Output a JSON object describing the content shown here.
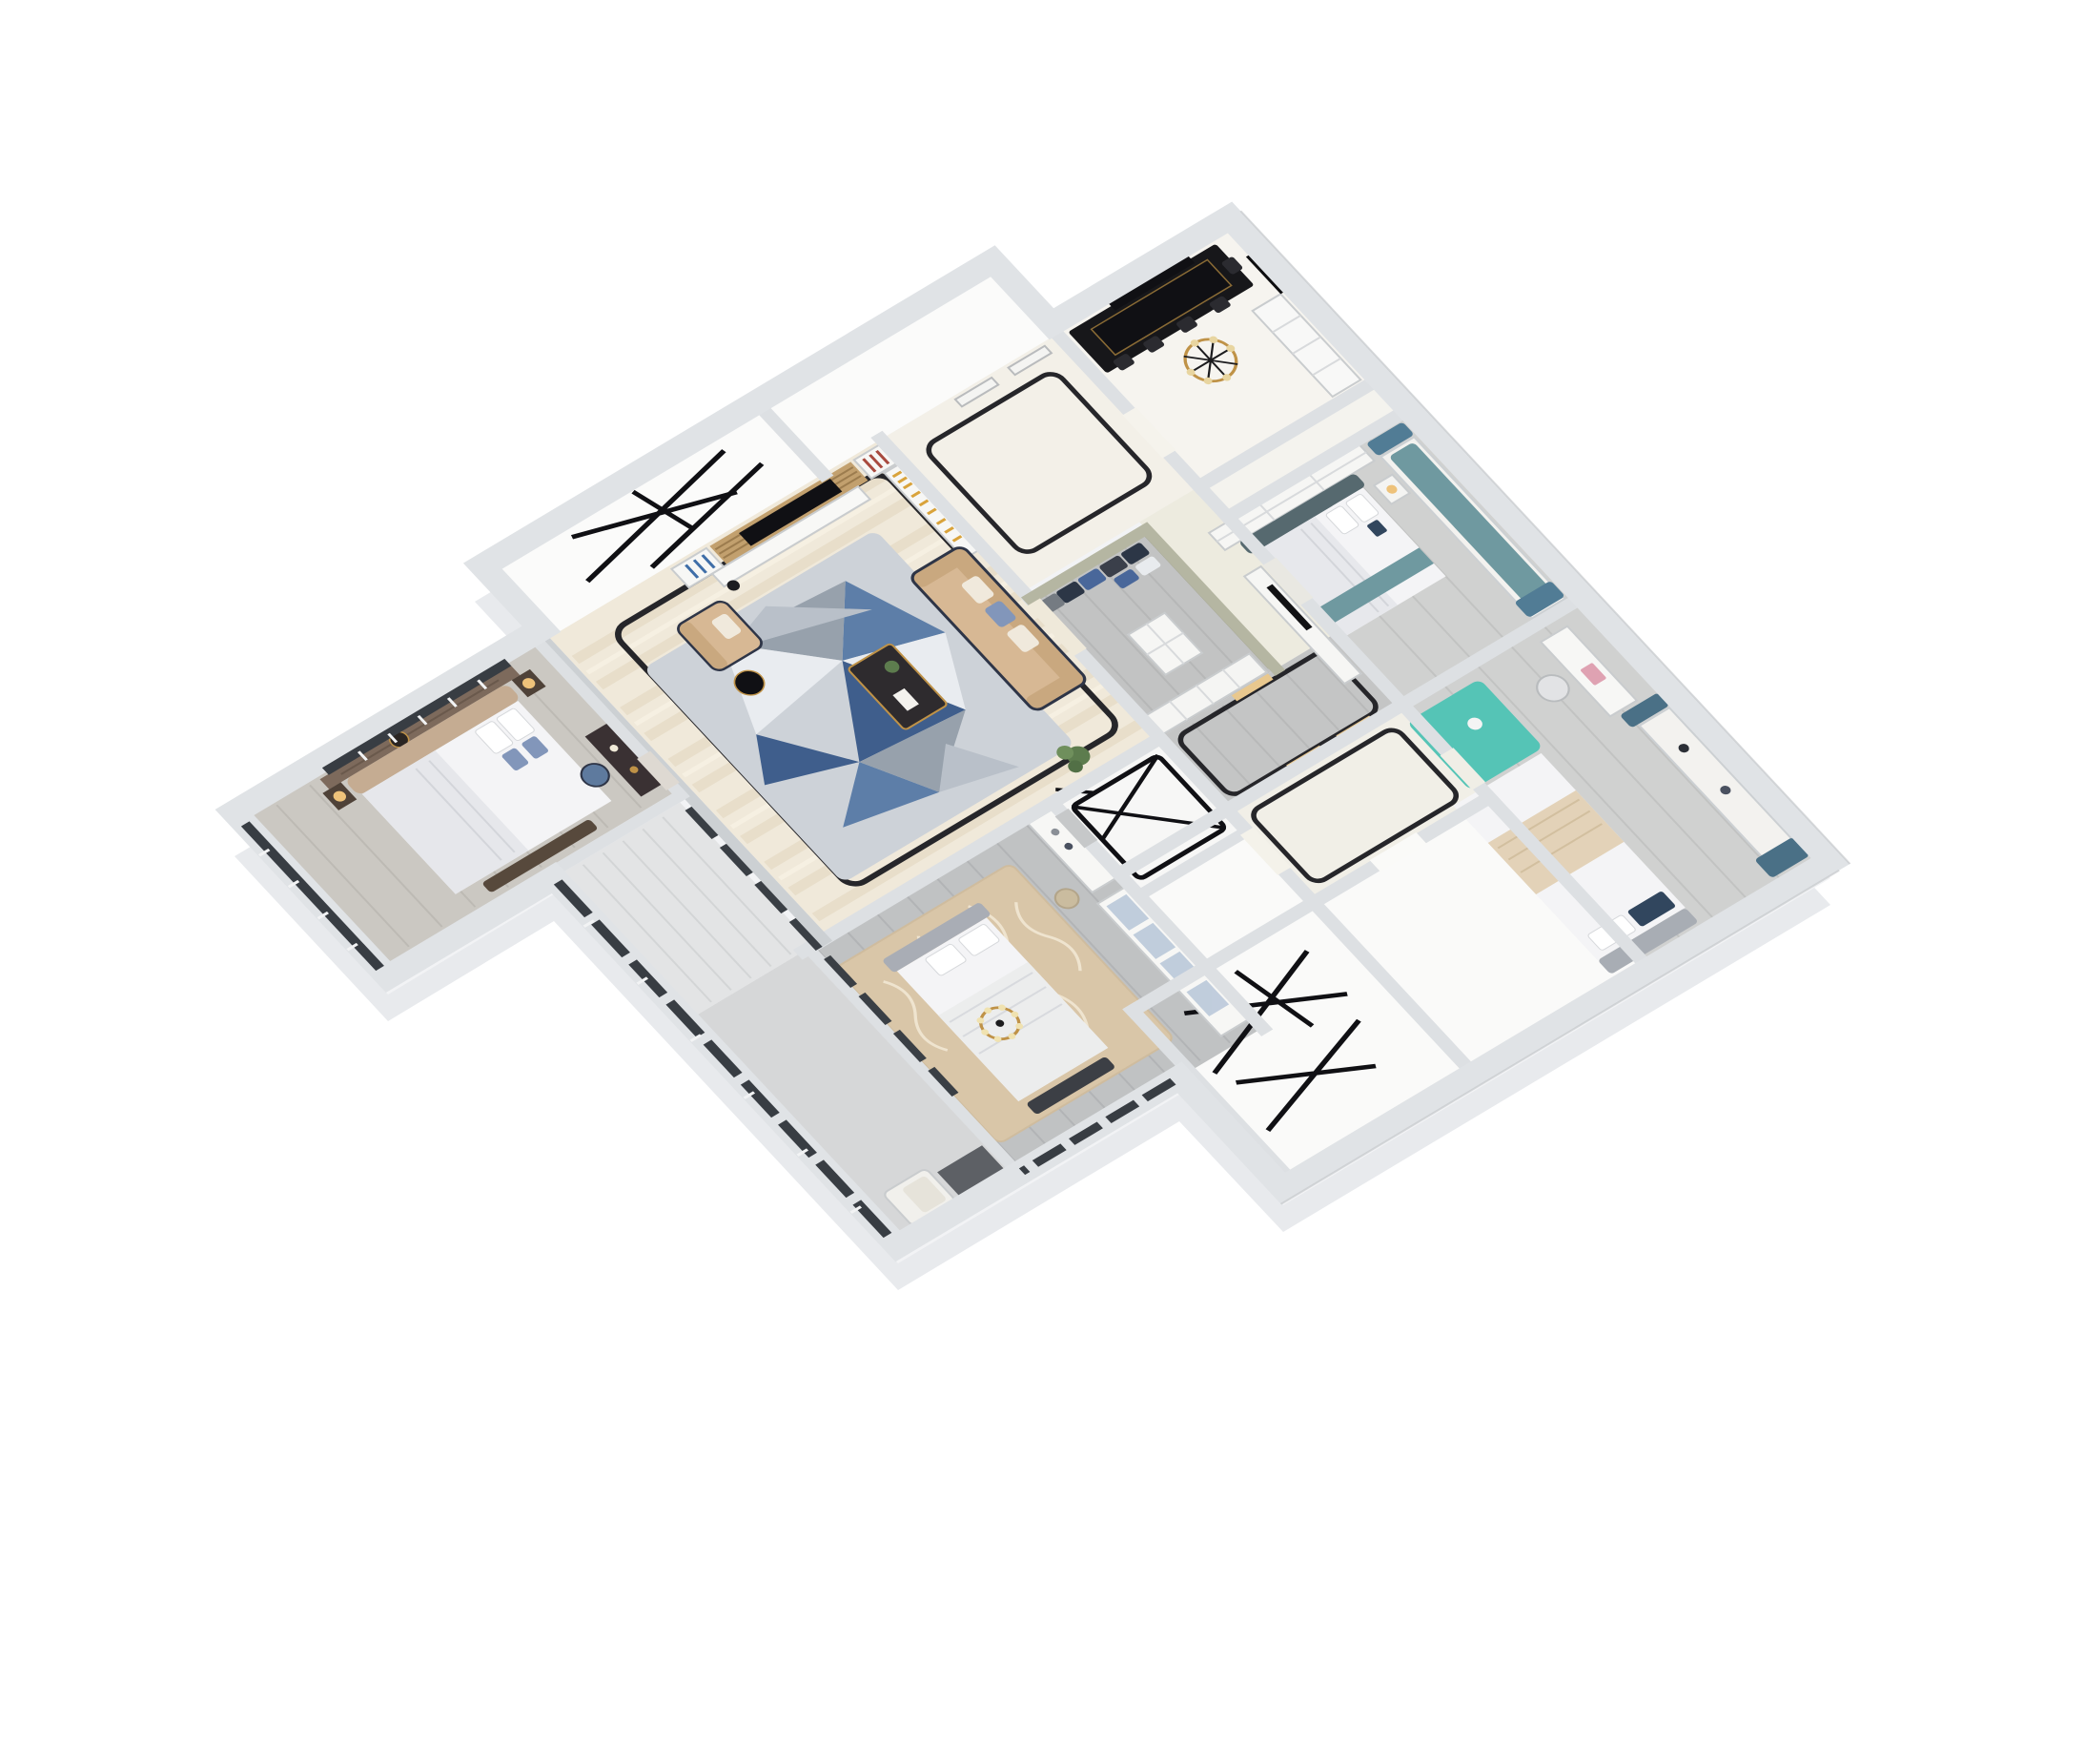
{
  "scene": {
    "description": "3D isometric dollhouse floor-plan rendering of a four-bedroom apartment, viewed from above at an angle on a plain white background",
    "view": "axonometric top-down",
    "background": "#ffffff"
  },
  "palette": {
    "background": "#ffffff",
    "wall_top": "#dde0e3",
    "wall_exterior": "#e0e3e6",
    "wall_khaki": "#b5b6a2",
    "extrude_side": "#e8eaed",
    "extrude_side_light": "#f2f3f5",
    "floor_white": "#fafaf8",
    "floor_marble": "#f3f0e8",
    "floor_wood_gray": "#cfd0cf",
    "floor_wood_dark": "#c0c2c3",
    "floor_master": "#cbc8c2",
    "floor_balcony": "#e3e4e5",
    "floor_corridor_south": "#d6d7d8",
    "living_marble": "#f0e9da",
    "marble_streak": "#e0d4ba",
    "inlay_black": "#26262a",
    "rug_base": "#cdd2d8",
    "rug_blue": "#5d7ea8",
    "rug_blue_dark": "#3f5e8c",
    "rug_gray": "#97a1ac",
    "rug_white": "#e9ecf0",
    "sofa_beige": "#d7b894",
    "sofa_shadow": "#c9a87f",
    "sofa_trim": "#2e3547",
    "table_dark": "#2e2b2e",
    "gold": "#bf9247",
    "gold_light": "#e8d5a0",
    "ink": "#101014",
    "bed_slate": "#56696f",
    "teal_cushion": "#6f99a0",
    "curtain_blue": "#517c95",
    "curtain_steel": "#4a7086",
    "rug_teal": "#55c4b6",
    "laptop_pink": "#dfa2b2",
    "pillow_navy": "#31465e",
    "master_brown": "#7d6a5c",
    "headboard_tan": "#c5ac92",
    "pillow_blue": "#8296ba",
    "bedding_white": "#f4f4f6",
    "duvet_gray": "#e6e7eb",
    "rug_beige": "#d9c6a8",
    "rug_beige_line": "#efe4cf",
    "wardrobe_glass": "#b7c6d8",
    "frame_dark": "#383d43",
    "bench_dark": "#3c3f45",
    "plant_green": "#5d7c4e",
    "lamp_warm": "#eec27a",
    "niche_warm": "#e9c88e",
    "clothes_navy": "#2c3646",
    "clothes_blue": "#49679a",
    "clothes_gray": "#757b82",
    "clothes_white": "#e8ebee",
    "chair_blue": "#5e7a9e",
    "cabinet_white": "#f7f7f5",
    "cabinet_stroke": "#c9ccce"
  },
  "rooms": [
    {
      "id": "dining-room",
      "features": [
        "gold-black chandelier",
        "black dining table",
        "black chairs",
        "white sideboard",
        "black framed screen",
        "dark doorway"
      ]
    },
    {
      "id": "bedroom-blue",
      "features": [
        "slate-teal bed",
        "teal window bench",
        "blue curtains",
        "wardrobe",
        "tv cabinet",
        "nightstand lamp"
      ]
    },
    {
      "id": "bedroom-study",
      "features": [
        "white desk",
        "pink laptop",
        "desk chair",
        "bright teal rug",
        "white bed",
        "steel-blue curtains",
        "window bench"
      ]
    },
    {
      "id": "foyer",
      "features": [
        "marble floor",
        "black rounded floor inlay",
        "doors"
      ]
    },
    {
      "id": "hallway",
      "features": [
        "marble floor",
        "black rounded floor inlay",
        "lit shelf niches"
      ]
    },
    {
      "id": "walk-in-closet",
      "features": [
        "hanging clothes",
        "glass front",
        "drawers",
        "shelves"
      ]
    },
    {
      "id": "shower-room",
      "features": [
        "black framed glass shower enclosure"
      ]
    },
    {
      "id": "utility-room-nw",
      "features": [
        "empty room",
        "black easel frames"
      ]
    },
    {
      "id": "utility-room-se",
      "features": [
        "empty room",
        "black easel frames"
      ]
    },
    {
      "id": "living-room",
      "features": [
        "wood slat tv wall",
        "black tv",
        "bookshelves",
        "geometric blue-gray rug",
        "beige sofa",
        "beige armchair",
        "dark coffee table",
        "black round side table",
        "plant",
        "streaked marble floor",
        "black floor inlay"
      ]
    },
    {
      "id": "master-bedroom",
      "features": [
        "brown padded headboard wall",
        "tan curved headboard",
        "blue-white pillows",
        "vanity desk",
        "blue chair",
        "warm lamps",
        "dark bay window"
      ]
    },
    {
      "id": "bedroom-south",
      "features": [
        "ornate beige rug",
        "gray bed with white bedding",
        "dark bench",
        "gold chandelier",
        "white wardrobe with glass doors",
        "stool",
        "shelf unit"
      ]
    },
    {
      "id": "balcony",
      "features": [
        "light plank floor",
        "dark framed windows",
        "glass sliding wall"
      ]
    },
    {
      "id": "corridor-south",
      "features": [
        "gray marble floor",
        "white armchair",
        "dark floor opening"
      ]
    }
  ]
}
